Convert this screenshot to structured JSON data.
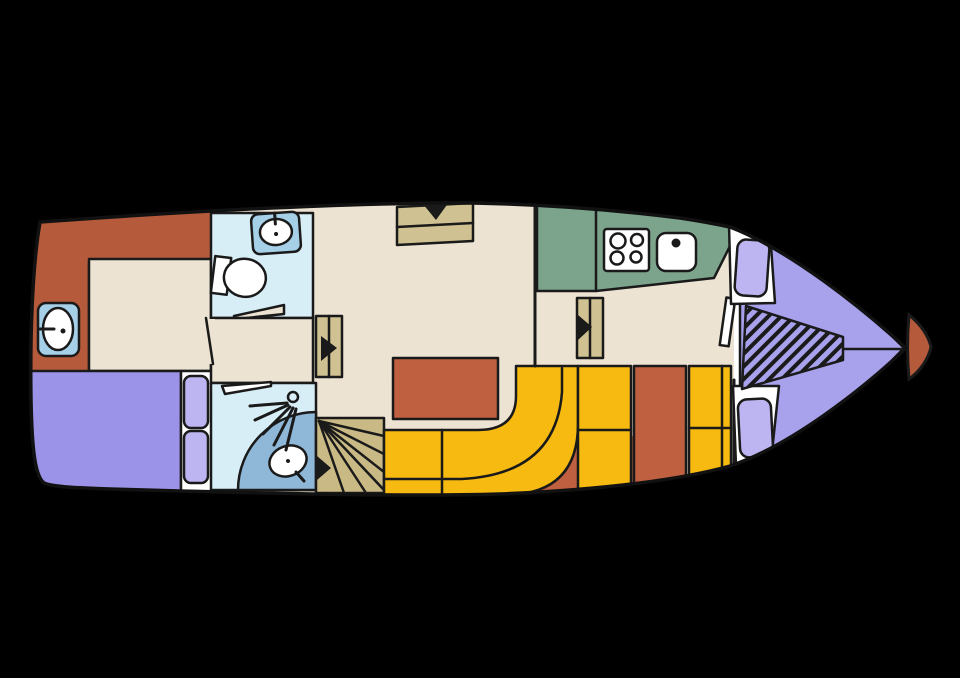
{
  "title": "Motor yacht deck plan (top view, bow right)",
  "colors": {
    "background": "#000000",
    "white": "#ffffff",
    "outline": "#1a1a1a",
    "floor_cream": "#ece3d2",
    "terracotta": "#b55a3a",
    "table_terracotta": "#bf6040",
    "bed_purple": "#9b93e7",
    "pillow_lilac": "#bcb5f1",
    "vberth_lavender": "#a8a2ed",
    "bath_blue": "#d8eef6",
    "tile_blue": "#a5d0e7",
    "tray_blue": "#8fb7d7",
    "galley_green": "#7ca38b",
    "steps_khaki": "#cfc191",
    "stairs_khaki": "#c9ba85",
    "bench_yellow": "#f7ba10"
  },
  "legend": {
    "rooms": [
      {
        "name": "aft-cabin",
        "desc": "stern cabin with single berth, vanity sink and double bed"
      },
      {
        "name": "toilet-room",
        "desc": "WC with toilet and washbasin"
      },
      {
        "name": "shower-room",
        "desc": "shower with quarter-round tray and shower head"
      },
      {
        "name": "saloon",
        "desc": "main saloon with table, curved bench and companionway steps"
      },
      {
        "name": "galley",
        "desc": "green counter with 4-burner hob and sink"
      },
      {
        "name": "dinette",
        "desc": "two facing benches with table"
      },
      {
        "name": "bow-cabin",
        "desc": "V-berth with two pillows and hatched foredeck wedge"
      }
    ],
    "icons": [
      "sink-icon",
      "toilet-icon",
      "shower-head-icon",
      "hob-icon",
      "steps-icon",
      "spiral-stairs-icon",
      "direction-arrow-icon"
    ]
  }
}
